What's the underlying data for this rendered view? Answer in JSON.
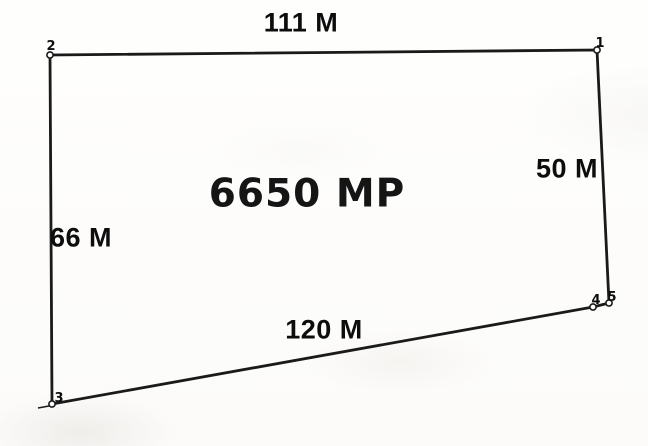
{
  "diagram": {
    "type": "land-plot-sketch",
    "area_label": "6650 MP",
    "sides": {
      "top": "111 M",
      "right": "50 M",
      "bottom": "120 M",
      "left": "66 M"
    },
    "vertices": [
      {
        "id": "2",
        "x": 50,
        "y": 55,
        "label_x": 51,
        "label_y": 50
      },
      {
        "id": "1",
        "x": 597,
        "y": 50,
        "label_x": 600,
        "label_y": 47
      },
      {
        "id": "5",
        "x": 609,
        "y": 303,
        "label_x": 612,
        "label_y": 301
      },
      {
        "id": "4",
        "x": 593,
        "y": 307,
        "label_x": 596,
        "label_y": 304
      },
      {
        "id": "3",
        "x": 52,
        "y": 404,
        "label_x": 59,
        "label_y": 402
      }
    ],
    "outline_order": [
      "2",
      "1",
      "5",
      "4",
      "3"
    ],
    "boundary_tick": {
      "x1": 38,
      "y1": 408,
      "x2": 49,
      "y2": 406
    },
    "colors": {
      "line": "#1a1a1a",
      "text": "#0d0d0d",
      "paper": "#fdfdfb"
    }
  }
}
